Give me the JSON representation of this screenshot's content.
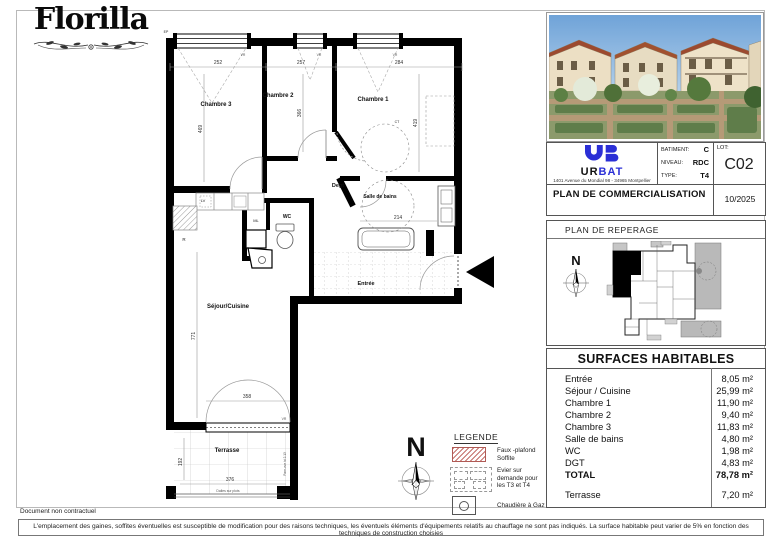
{
  "brand": {
    "name": "Florilla"
  },
  "titleblock": {
    "logo_ur": "UR",
    "logo_bat": "BAT",
    "address": "1401 Avenue du Mondial 98 - 34965 Montpellier",
    "batiment_label": "BATIMENT:",
    "batiment_value": "C",
    "niveau_label": "NIVEAU:",
    "niveau_value": "RDC",
    "type_label": "TYPE:",
    "type_value": "T4",
    "lot_label": "LOT:",
    "lot_value": "C02",
    "plan_title": "PLAN DE COMMERCIALISATION",
    "date": "10/2025"
  },
  "reperage": {
    "title": "PLAN DE REPERAGE",
    "north": "N"
  },
  "surfaces": {
    "title": "SURFACES HABITABLES",
    "rows": [
      {
        "label": "Entrée",
        "value": "8,05 m²"
      },
      {
        "label": "Séjour / Cuisine",
        "value": "25,99 m²"
      },
      {
        "label": "Chambre 1",
        "value": "11,90 m²"
      },
      {
        "label": "Chambre 2",
        "value": "9,40 m²"
      },
      {
        "label": "Chambre 3",
        "value": "11,83 m²"
      },
      {
        "label": "Salle de bains",
        "value": "4,80 m²"
      },
      {
        "label": "WC",
        "value": "1,98 m²"
      },
      {
        "label": "DGT",
        "value": "4,83 m²"
      }
    ],
    "total_label": "TOTAL",
    "total_value": "78,78 m²",
    "terrasse_label": "Terrasse",
    "terrasse_value": "7,20 m²"
  },
  "legend": {
    "title": "LEGENDE",
    "item_faux_plafond": "Faux -plafond Soffite",
    "item_evier": "Evier sur demande pour les T3 et T4",
    "item_chaudiere": "Chaudière à Gaz",
    "north": "N"
  },
  "plan": {
    "rooms": {
      "chambre3": "Chambre 3",
      "chambre2": "Chambre 2",
      "chambre1": "Chambre 1",
      "degt": "Degt",
      "sdb": "Salle de bains",
      "wc": "WC",
      "entree": "Entrée",
      "sejour": "Séjour/Cuisine",
      "terrasse": "Terrasse"
    },
    "dims": {
      "ch3_w": "252",
      "ch2_w": "257",
      "ch1_w": "284",
      "ch3_h": "469",
      "ch2_h": "366",
      "ch1_h": "419",
      "sdb_w": "214",
      "sejour_h": "771",
      "door_w": "358",
      "terr_w": "376",
      "terr_h": "192"
    },
    "equip": {
      "lv": "LV",
      "r": "R",
      "ml": "ML",
      "vr": "VR",
      "ep": "EP",
      "ct": "CT"
    },
    "terrace_note": "Dalles sur plots",
    "terrace_side_note": "Pare-vue ht 2.13"
  },
  "footer": {
    "note": "Document non contractuel",
    "disclaimer": "L'emplacement des gaines, soffites éventuelles est susceptible de modification pour des raisons techniques, les éventuels éléments d'équipements relatifs au chauffage ne sont pas indiqués. La surface habitable peut varier de 5% en fonction des techniques de construction choisies"
  },
  "colors": {
    "accent_blue": "#2b2fd6",
    "hatch_red": "#c4706b"
  }
}
